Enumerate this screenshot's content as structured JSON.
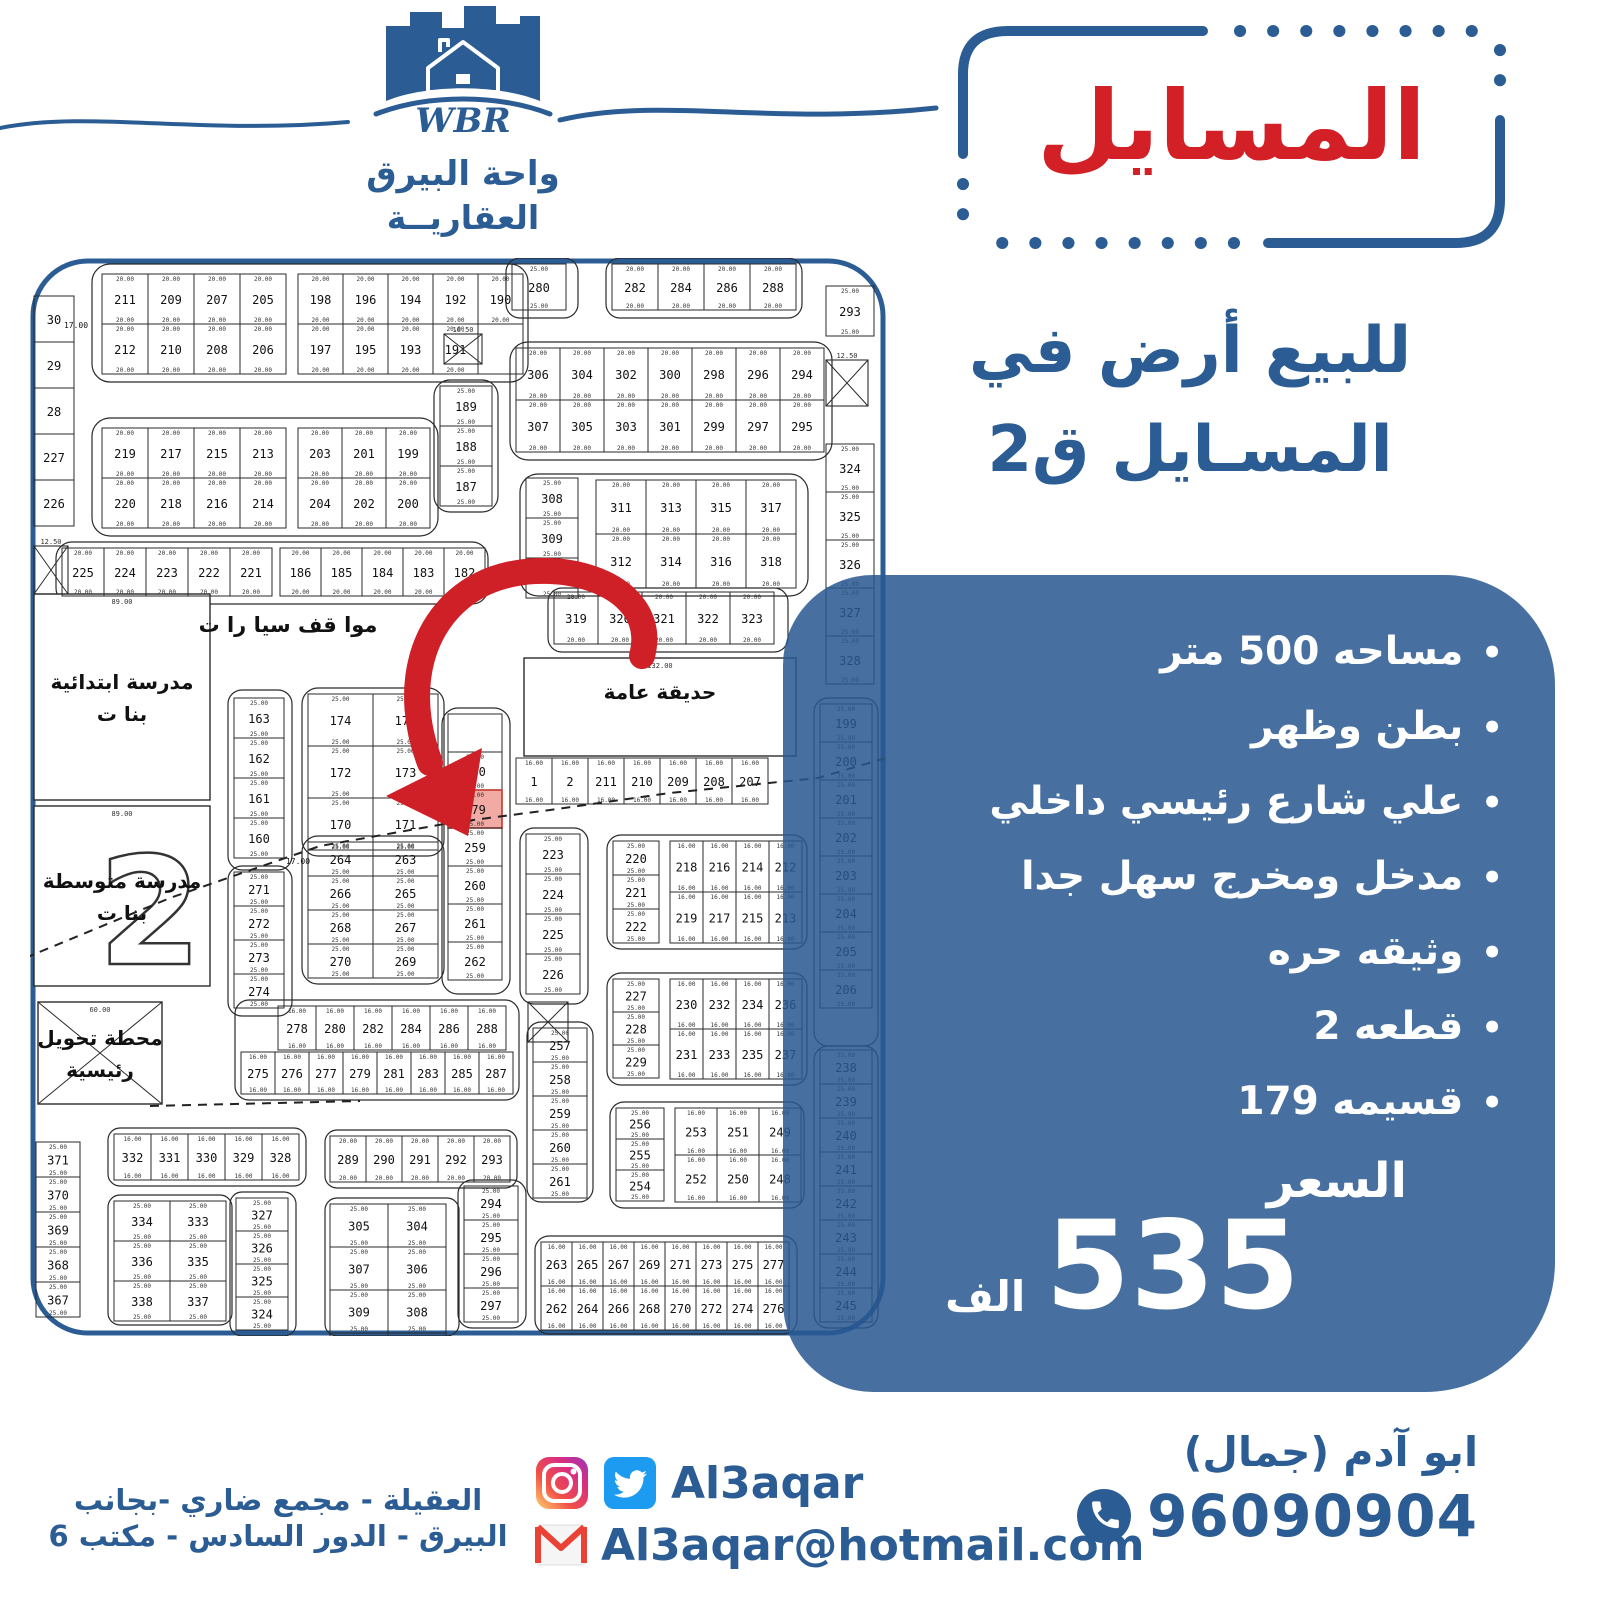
{
  "brand": {
    "initials": "WBR",
    "name_line1": "واحة البيرق",
    "name_line2": "العقاريــة"
  },
  "title": {
    "text": "المسايل"
  },
  "heading": {
    "line1": "للبيع أرض في",
    "line2": "المسـايل ق2"
  },
  "panel": {
    "bullets": [
      "مساحه 500 متر",
      "بطن وظهر",
      "علي شارع رئيسي داخلي",
      "مدخل ومخرج سهل جدا",
      "وثيقه حره",
      "قطعه 2",
      "قسيمه 179"
    ],
    "price_label": "السعر",
    "price_value": "535",
    "price_unit": "الف"
  },
  "contact": {
    "name": "ابو آدم (جمال)",
    "phone": "96090904",
    "social_handle": "Al3aqar",
    "email": "Al3aqar@hotmail.com",
    "address_line1": "العقيلة - مجمع ضاري -بجانب",
    "address_line2": "البيرق - الدور السادس - مكتب 6"
  },
  "colors": {
    "brand_blue": "#2b5d94",
    "title_red": "#d32027",
    "panel_blue": "rgba(41,88,145,0.86)",
    "highlight_plot": "#f2aaa4",
    "map_line": "#2a2a2a",
    "twitter": "#1d9bf0",
    "gmail_red": "#ea4335"
  },
  "map": {
    "highlight": "179",
    "arrow": {
      "path": "M 612,398 C 632,322 516,292 448,328 C 390,360 372,432 400,505",
      "head": "438,578 356,538 452,490"
    },
    "dashes": [
      [
        [
          -5,
          700
        ],
        [
          140,
          640
        ],
        [
          290,
          588
        ],
        [
          420,
          565
        ],
        [
          520,
          552
        ],
        [
          640,
          535
        ],
        [
          788,
          520
        ],
        [
          856,
          500
        ]
      ],
      [
        [
          120,
          848
        ],
        [
          330,
          843
        ]
      ]
    ],
    "loops": [
      [
        62,
        6,
        436,
        118,
        18
      ],
      [
        62,
        160,
        346,
        118,
        18
      ],
      [
        404,
        122,
        64,
        132,
        16
      ],
      [
        26,
        284,
        432,
        62,
        16
      ],
      [
        476,
        0,
        72,
        60,
        14
      ],
      [
        576,
        0,
        196,
        60,
        14
      ],
      [
        480,
        84,
        322,
        118,
        18
      ],
      [
        490,
        216,
        288,
        122,
        18
      ],
      [
        518,
        330,
        240,
        64,
        14
      ],
      [
        412,
        450,
        68,
        286,
        16
      ],
      [
        272,
        430,
        142,
        168,
        16
      ],
      [
        272,
        578,
        142,
        148,
        16
      ],
      [
        198,
        432,
        64,
        180,
        14
      ],
      [
        198,
        608,
        64,
        150,
        14
      ],
      [
        490,
        570,
        68,
        176,
        14
      ],
      [
        497,
        764,
        66,
        180,
        14
      ],
      [
        577,
        577,
        200,
        114,
        14
      ],
      [
        577,
        715,
        200,
        112,
        14
      ],
      [
        580,
        844,
        194,
        106,
        14
      ],
      [
        505,
        978,
        262,
        98,
        14
      ],
      [
        428,
        922,
        68,
        148,
        14
      ],
      [
        78,
        870,
        198,
        58,
        12
      ],
      [
        78,
        937,
        124,
        130,
        12
      ],
      [
        200,
        934,
        66,
        144,
        12
      ],
      [
        295,
        872,
        192,
        58,
        12
      ],
      [
        295,
        940,
        134,
        138,
        12
      ],
      [
        205,
        742,
        284,
        100,
        14
      ],
      [
        784,
        440,
        64,
        348,
        14
      ],
      [
        784,
        788,
        64,
        282,
        14
      ]
    ],
    "blocks": [
      {
        "x": 72,
        "y": 16,
        "cw": 46,
        "ch": 50,
        "dim": "20.00",
        "rows": [
          [
            "211",
            "209",
            "207",
            "205"
          ],
          [
            "212",
            "210",
            "208",
            "206"
          ]
        ]
      },
      {
        "x": 268,
        "y": 16,
        "cw": 45,
        "ch": 50,
        "dim": "20.00",
        "rows": [
          [
            "198",
            "196",
            "194",
            "192",
            "190"
          ],
          [
            "197",
            "195",
            "193",
            "191",
            ""
          ]
        ]
      },
      {
        "x": 72,
        "y": 170,
        "cw": 46,
        "ch": 50,
        "dim": "20.00",
        "rows": [
          [
            "219",
            "217",
            "215",
            "213"
          ],
          [
            "220",
            "218",
            "216",
            "214"
          ]
        ]
      },
      {
        "x": 268,
        "y": 170,
        "cw": 44,
        "ch": 50,
        "dim": "20.00",
        "rows": [
          [
            "203",
            "201",
            "199"
          ],
          [
            "204",
            "202",
            "200"
          ]
        ]
      },
      {
        "x": 410,
        "y": 128,
        "cw": 52,
        "ch": 40,
        "dim": "25.00",
        "rows": [
          [
            "189"
          ],
          [
            "188"
          ],
          [
            "187"
          ]
        ]
      },
      {
        "x": 4,
        "y": 38,
        "cw": 40,
        "ch": 46,
        "rows": [
          [
            "30"
          ],
          [
            "29"
          ],
          [
            "28"
          ],
          [
            "227"
          ],
          [
            "226"
          ]
        ]
      },
      {
        "x": 32,
        "y": 290,
        "cw": 42,
        "ch": 48,
        "dim": "20.00",
        "rows": [
          [
            "225",
            "224",
            "223",
            "222",
            "221"
          ]
        ]
      },
      {
        "x": 250,
        "y": 290,
        "cw": 41,
        "ch": 48,
        "dim": "20.00",
        "rows": [
          [
            "186",
            "185",
            "184",
            "183",
            "182"
          ]
        ]
      },
      {
        "x": 482,
        "y": 6,
        "cw": 54,
        "ch": 46,
        "dim": "25.00",
        "rows": [
          [
            "280"
          ]
        ]
      },
      {
        "x": 582,
        "y": 6,
        "cw": 46,
        "ch": 46,
        "dim": "20.00",
        "rows": [
          [
            "282",
            "284",
            "286",
            "288"
          ]
        ]
      },
      {
        "x": 796,
        "y": 28,
        "cw": 48,
        "ch": 50,
        "dim": "25.00",
        "rows": [
          [
            "293"
          ]
        ]
      },
      {
        "x": 486,
        "y": 90,
        "cw": 44,
        "ch": 52,
        "dim": "20.00",
        "rows": [
          [
            "306",
            "304",
            "302",
            "300",
            "298",
            "296",
            "294"
          ],
          [
            "307",
            "305",
            "303",
            "301",
            "299",
            "297",
            "295"
          ]
        ]
      },
      {
        "x": 796,
        "y": 186,
        "cw": 48,
        "ch": 48,
        "dim": "25.00",
        "rows": [
          [
            "324"
          ],
          [
            "325"
          ],
          [
            "326"
          ],
          [
            "327"
          ],
          [
            "328"
          ]
        ]
      },
      {
        "x": 496,
        "y": 220,
        "cw": 52,
        "ch": 40,
        "dim": "25.00",
        "rows": [
          [
            "308"
          ],
          [
            "309"
          ],
          [
            "310"
          ]
        ]
      },
      {
        "x": 566,
        "y": 222,
        "cw": 50,
        "ch": 54,
        "dim": "20.00",
        "rows": [
          [
            "311",
            "313",
            "315",
            "317"
          ],
          [
            "312",
            "314",
            "316",
            "318"
          ]
        ]
      },
      {
        "x": 524,
        "y": 334,
        "cw": 44,
        "ch": 52,
        "dim": "20.00",
        "rows": [
          [
            "319",
            "320",
            "321",
            "322",
            "323"
          ]
        ]
      },
      {
        "x": 486,
        "y": 500,
        "cw": 36,
        "ch": 46,
        "dim": "16.00",
        "rows": [
          [
            "1",
            "2",
            "211",
            "210",
            "209",
            "208",
            "207"
          ]
        ]
      },
      {
        "x": 204,
        "y": 440,
        "cw": 50,
        "ch": 40,
        "dim": "25.00",
        "rows": [
          [
            "163"
          ],
          [
            "162"
          ],
          [
            "161"
          ],
          [
            "160"
          ]
        ]
      },
      {
        "x": 204,
        "y": 614,
        "cw": 50,
        "ch": 34,
        "dim": "25.00",
        "rows": [
          [
            "271"
          ],
          [
            "272"
          ],
          [
            "273"
          ],
          [
            "274"
          ]
        ]
      },
      {
        "x": 278,
        "y": 436,
        "cw": 65,
        "ch": 52,
        "dim": "25.00",
        "rows": [
          [
            "174",
            "175"
          ],
          [
            "172",
            "173"
          ],
          [
            "170",
            "171"
          ]
        ]
      },
      {
        "x": 278,
        "y": 584,
        "cw": 65,
        "ch": 34,
        "dim": "25.00",
        "rows": [
          [
            "264",
            "263"
          ],
          [
            "266",
            "265"
          ],
          [
            "268",
            "267"
          ],
          [
            "270",
            "269"
          ]
        ]
      },
      {
        "x": 418,
        "y": 456,
        "cw": 54,
        "ch": 38,
        "dim": "25.00",
        "rows": [
          [
            ""
          ],
          [
            "180"
          ],
          [
            "179"
          ],
          [
            "259"
          ],
          [
            "260"
          ],
          [
            "261"
          ],
          [
            "262"
          ]
        ]
      },
      {
        "x": 496,
        "y": 576,
        "cw": 54,
        "ch": 40,
        "dim": "25.00",
        "rows": [
          [
            "223"
          ],
          [
            "224"
          ],
          [
            "225"
          ],
          [
            "226"
          ]
        ]
      },
      {
        "x": 503,
        "y": 770,
        "cw": 54,
        "ch": 34,
        "dim": "25.00",
        "rows": [
          [
            "257"
          ],
          [
            "258"
          ],
          [
            "259"
          ],
          [
            "260"
          ],
          [
            "261"
          ]
        ]
      },
      {
        "x": 583,
        "y": 583,
        "cw": 46,
        "ch": 34,
        "dim": "25.00",
        "rows": [
          [
            "220"
          ],
          [
            "221"
          ],
          [
            "222"
          ]
        ]
      },
      {
        "x": 640,
        "y": 583,
        "cw": 33,
        "ch": 51,
        "dim": "16.00",
        "rows": [
          [
            "218",
            "216",
            "214",
            "212"
          ],
          [
            "219",
            "217",
            "215",
            "213"
          ]
        ]
      },
      {
        "x": 583,
        "y": 721,
        "cw": 46,
        "ch": 33,
        "dim": "25.00",
        "rows": [
          [
            "227"
          ],
          [
            "228"
          ],
          [
            "229"
          ]
        ]
      },
      {
        "x": 640,
        "y": 721,
        "cw": 33,
        "ch": 50,
        "dim": "16.00",
        "rows": [
          [
            "230",
            "232",
            "234",
            "236"
          ],
          [
            "231",
            "233",
            "235",
            "237"
          ]
        ]
      },
      {
        "x": 586,
        "y": 850,
        "cw": 48,
        "ch": 31,
        "dim": "25.00",
        "rows": [
          [
            "256"
          ],
          [
            "255"
          ],
          [
            "254"
          ]
        ]
      },
      {
        "x": 645,
        "y": 850,
        "cw": 42,
        "ch": 47,
        "dim": "16.00",
        "rows": [
          [
            "253",
            "251",
            "249"
          ],
          [
            "252",
            "250",
            "248"
          ]
        ]
      },
      {
        "x": 511,
        "y": 984,
        "cw": 31,
        "ch": 44,
        "dim": "16.00",
        "rows": [
          [
            "263",
            "265",
            "267",
            "269",
            "271",
            "273",
            "275",
            "277"
          ],
          [
            "262",
            "264",
            "266",
            "268",
            "270",
            "272",
            "274",
            "276"
          ]
        ]
      },
      {
        "x": 434,
        "y": 928,
        "cw": 54,
        "ch": 34,
        "dim": "25.00",
        "rows": [
          [
            "294"
          ],
          [
            "295"
          ],
          [
            "296"
          ],
          [
            "297"
          ]
        ]
      },
      {
        "x": 6,
        "y": 884,
        "cw": 44,
        "ch": 35,
        "dim": "25.00",
        "rows": [
          [
            "371"
          ],
          [
            "370"
          ],
          [
            "369"
          ],
          [
            "368"
          ],
          [
            "367"
          ]
        ]
      },
      {
        "x": 84,
        "y": 876,
        "cw": 37,
        "ch": 46,
        "dim": "16.00",
        "rows": [
          [
            "332",
            "331",
            "330",
            "329",
            "328"
          ]
        ]
      },
      {
        "x": 84,
        "y": 943,
        "cw": 56,
        "ch": 40,
        "dim": "25.00",
        "rows": [
          [
            "334",
            "333"
          ],
          [
            "336",
            "335"
          ],
          [
            "338",
            "337"
          ]
        ]
      },
      {
        "x": 206,
        "y": 940,
        "cw": 52,
        "ch": 33,
        "dim": "25.00",
        "rows": [
          [
            "327"
          ],
          [
            "326"
          ],
          [
            "325"
          ],
          [
            "324"
          ]
        ]
      },
      {
        "x": 300,
        "y": 878,
        "cw": 36,
        "ch": 46,
        "dim": "20.00",
        "rows": [
          [
            "289",
            "290",
            "291",
            "292",
            "293"
          ]
        ]
      },
      {
        "x": 300,
        "y": 946,
        "cw": 58,
        "ch": 43,
        "dim": "25.00",
        "rows": [
          [
            "305",
            "304"
          ],
          [
            "307",
            "306"
          ],
          [
            "309",
            "308"
          ],
          [
            "311",
            "310"
          ]
        ]
      },
      {
        "x": 248,
        "y": 748,
        "cw": 38,
        "ch": 44,
        "dim": "16.00",
        "rows": [
          [
            "278",
            "280",
            "282",
            "284",
            "286",
            "288"
          ]
        ]
      },
      {
        "x": 211,
        "y": 794,
        "cw": 34,
        "ch": 42,
        "dim": "16.00",
        "rows": [
          [
            "275",
            "276",
            "277",
            "279",
            "281",
            "283",
            "285",
            "287"
          ]
        ]
      },
      {
        "x": 790,
        "y": 446,
        "cw": 52,
        "ch": 38,
        "dim": "25.00",
        "rows": [
          [
            "199"
          ],
          [
            "200"
          ],
          [
            "201"
          ],
          [
            "202"
          ],
          [
            "203"
          ],
          [
            "204"
          ],
          [
            "205"
          ],
          [
            "206"
          ]
        ]
      },
      {
        "x": 790,
        "y": 792,
        "cw": 52,
        "ch": 34,
        "dim": "25.00",
        "rows": [
          [
            "238"
          ],
          [
            "239"
          ],
          [
            "240"
          ],
          [
            "241"
          ],
          [
            "242"
          ],
          [
            "243"
          ],
          [
            "244"
          ],
          [
            "245"
          ]
        ]
      }
    ],
    "areas": [
      {
        "x": 4,
        "y": 336,
        "w": 176,
        "h": 206,
        "dim": "89.00",
        "labels": [
          "مدرسة ابتدائية",
          "بنا ت"
        ]
      },
      {
        "x": 4,
        "y": 548,
        "w": 176,
        "h": 180,
        "dim": "89.00",
        "labels": [
          "مدرسة متوسطة",
          "بنا ت"
        ],
        "big": "2"
      },
      {
        "x": 494,
        "y": 400,
        "w": 272,
        "h": 98,
        "dim": "132.00",
        "labels": [
          "حديقة عامة"
        ]
      },
      {
        "x": 8,
        "y": 744,
        "w": 124,
        "h": 102,
        "dim": "60.00",
        "labels": [
          "محطة تحويل",
          "رئيسية"
        ],
        "cross": true
      }
    ],
    "xboxes": [
      {
        "x": 4,
        "y": 288,
        "w": 34,
        "h": 48,
        "dim": "12.50"
      },
      {
        "x": 796,
        "y": 102,
        "w": 42,
        "h": 46,
        "dim": "12.50"
      },
      {
        "x": 414,
        "y": 76,
        "w": 38,
        "h": 30,
        "dim": "16.50"
      },
      {
        "x": 498,
        "y": 744,
        "w": 40,
        "h": 40,
        "dim": ""
      }
    ],
    "slabels": [
      {
        "t": "موا قف سيا را ت",
        "x": 258,
        "y": 374,
        "s": 21,
        "b": true
      },
      {
        "t": "17.00",
        "x": 46,
        "y": 70,
        "s": 8
      },
      {
        "t": "19.00",
        "x": 430,
        "y": 344,
        "s": 8
      },
      {
        "t": "17.00",
        "x": 268,
        "y": 606,
        "s": 8
      }
    ]
  }
}
